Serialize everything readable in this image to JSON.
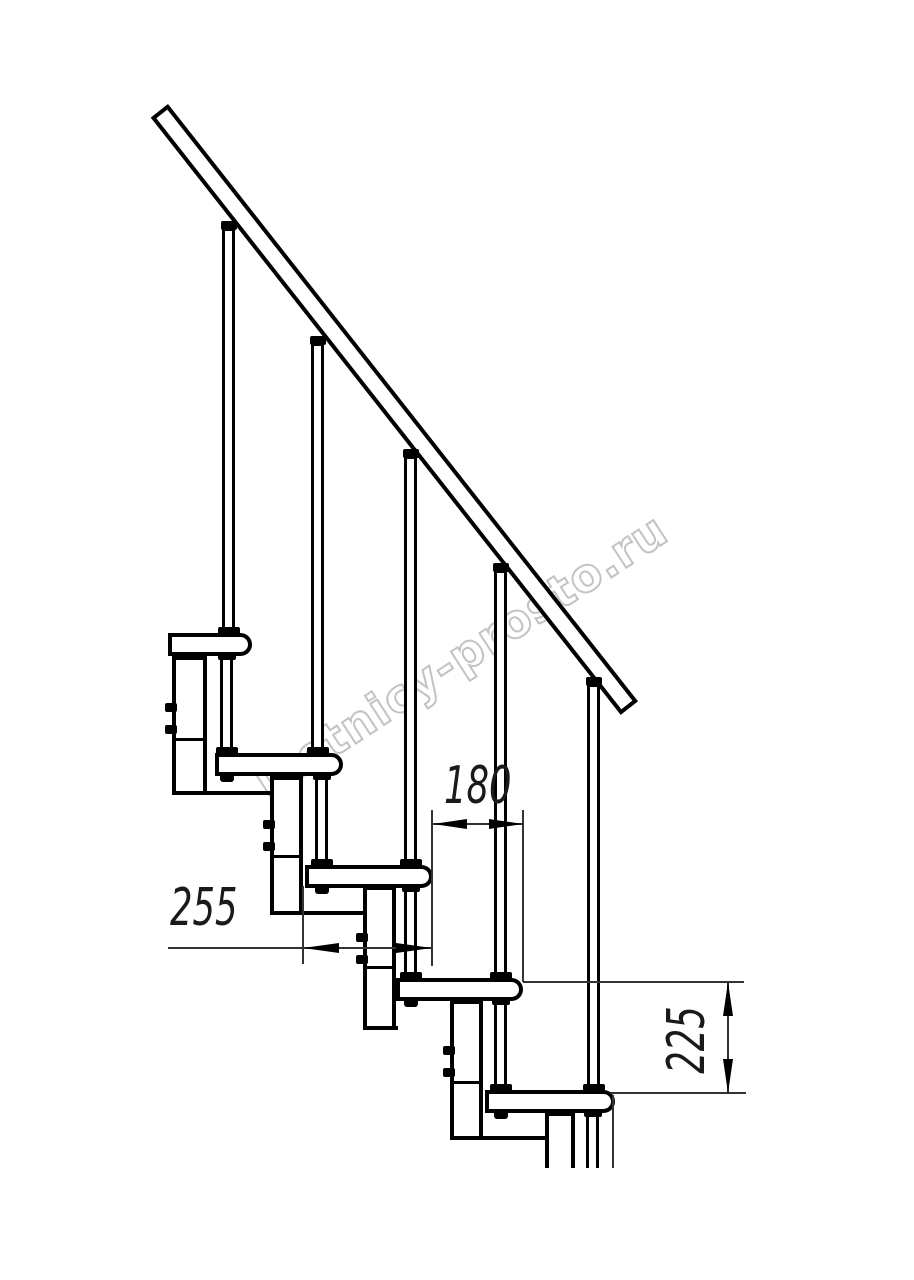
{
  "drawing": {
    "subject": "modular staircase side elevation fragment",
    "background_color": "#ffffff",
    "line_color": "#000000",
    "thin_line_color": "#333333",
    "counts": {
      "treads_visible": 5,
      "balusters_visible": 5,
      "support_modules_visible": 5
    },
    "watermark": {
      "text": "lestnicy-prosto.ru",
      "color": "#c3c3c3"
    },
    "dimensions": {
      "tread_depth": {
        "value": "255",
        "orientation": "horizontal"
      },
      "step_run": {
        "value": "180",
        "orientation": "horizontal"
      },
      "step_rise": {
        "value": "225",
        "orientation": "vertical"
      }
    }
  }
}
